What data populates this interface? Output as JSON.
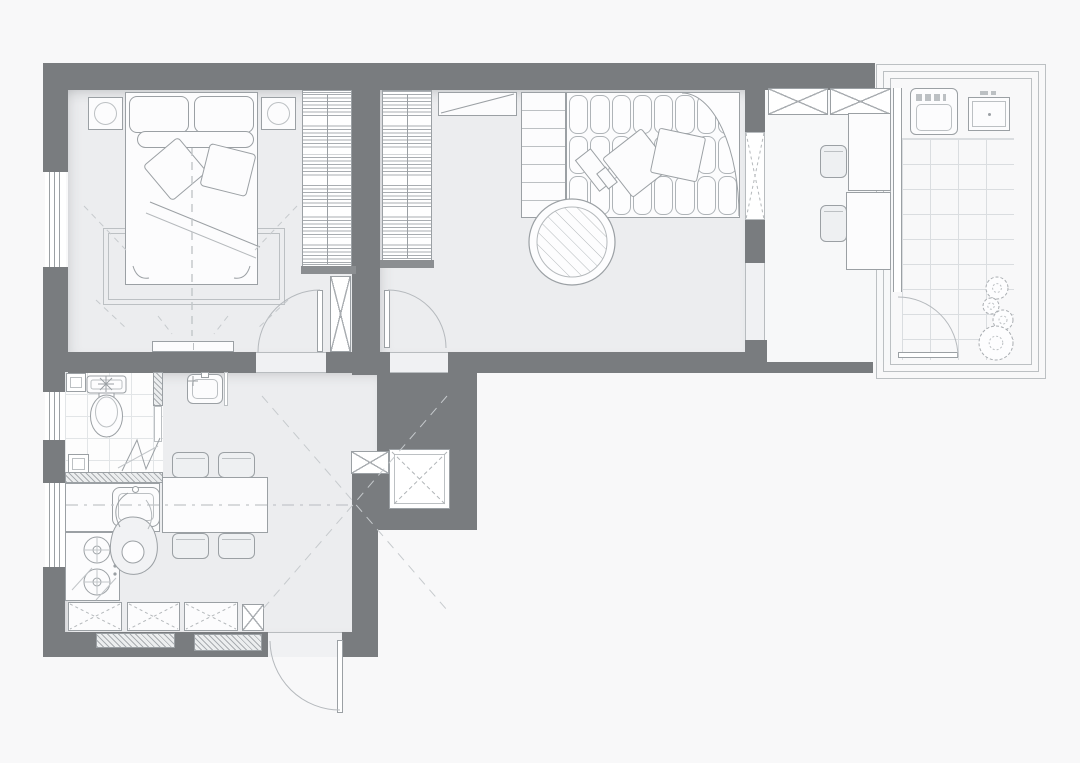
{
  "title": "apartment-floor-plan",
  "palette": {
    "wall": "#797c7f",
    "floor": "#ecedef",
    "wet_floor": "#fdfdfd",
    "office_floor": "#f7f8f9",
    "exterior": "#f8f8f9",
    "stroke": "#9ba0a4",
    "stroke_light": "#bcc0c3",
    "grid_line": "#dadde0",
    "grid_line_bath": "#e2e5e7",
    "hatch": "#a9adb1",
    "dash": "#c2c6c9"
  },
  "rooms": [
    {
      "id": "bedroom"
    },
    {
      "id": "living-room"
    },
    {
      "id": "home-office"
    },
    {
      "id": "balcony"
    },
    {
      "id": "bathroom"
    },
    {
      "id": "kitchen-dining"
    },
    {
      "id": "hallway"
    }
  ],
  "furniture_inventory": {
    "bedroom": [
      "double-bed",
      "pillows",
      "nightstand-left",
      "nightstand-right",
      "rug",
      "bench",
      "wardrobe"
    ],
    "living_room": [
      "corner-sofa",
      "sofa-pillows",
      "round-coffee-table",
      "tv-shelf",
      "shelf-unit",
      "wardrobe"
    ],
    "home_office": [
      "desk",
      "side-table",
      "chair",
      "chair",
      "wall-cabinets"
    ],
    "balcony": [
      "washing-machine",
      "utility-sink",
      "plants",
      "tiled-floor"
    ],
    "bathroom": [
      "toilet",
      "washbasin",
      "floor-drain",
      "folding-door"
    ],
    "kitchen": [
      "counter",
      "kitchen-sink",
      "cooktop",
      "dining-table",
      "chairs",
      "base-cabinets",
      "radiators",
      "person-figure"
    ]
  },
  "sofa": {
    "rows": 3,
    "cols": 8
  },
  "balcony": {
    "tile_size_px": [
      28,
      25
    ],
    "plants": [
      {
        "cx": 997,
        "cy": 288,
        "r": 11
      },
      {
        "cx": 991,
        "cy": 306,
        "r": 8
      },
      {
        "cx": 1003,
        "cy": 320,
        "r": 10
      },
      {
        "cx": 996,
        "cy": 343,
        "r": 17
      }
    ]
  },
  "bathroom": {
    "tile_size_px": [
      22,
      22
    ]
  },
  "doors": [
    {
      "id": "bedroom-door"
    },
    {
      "id": "living-room-door"
    },
    {
      "id": "entry-door"
    },
    {
      "id": "balcony-door"
    },
    {
      "id": "bathroom-folding-door"
    }
  ],
  "windows": [
    {
      "id": "bedroom-window"
    },
    {
      "id": "bathroom-window"
    },
    {
      "id": "kitchen-window"
    },
    {
      "id": "interior-window-living-office"
    }
  ]
}
